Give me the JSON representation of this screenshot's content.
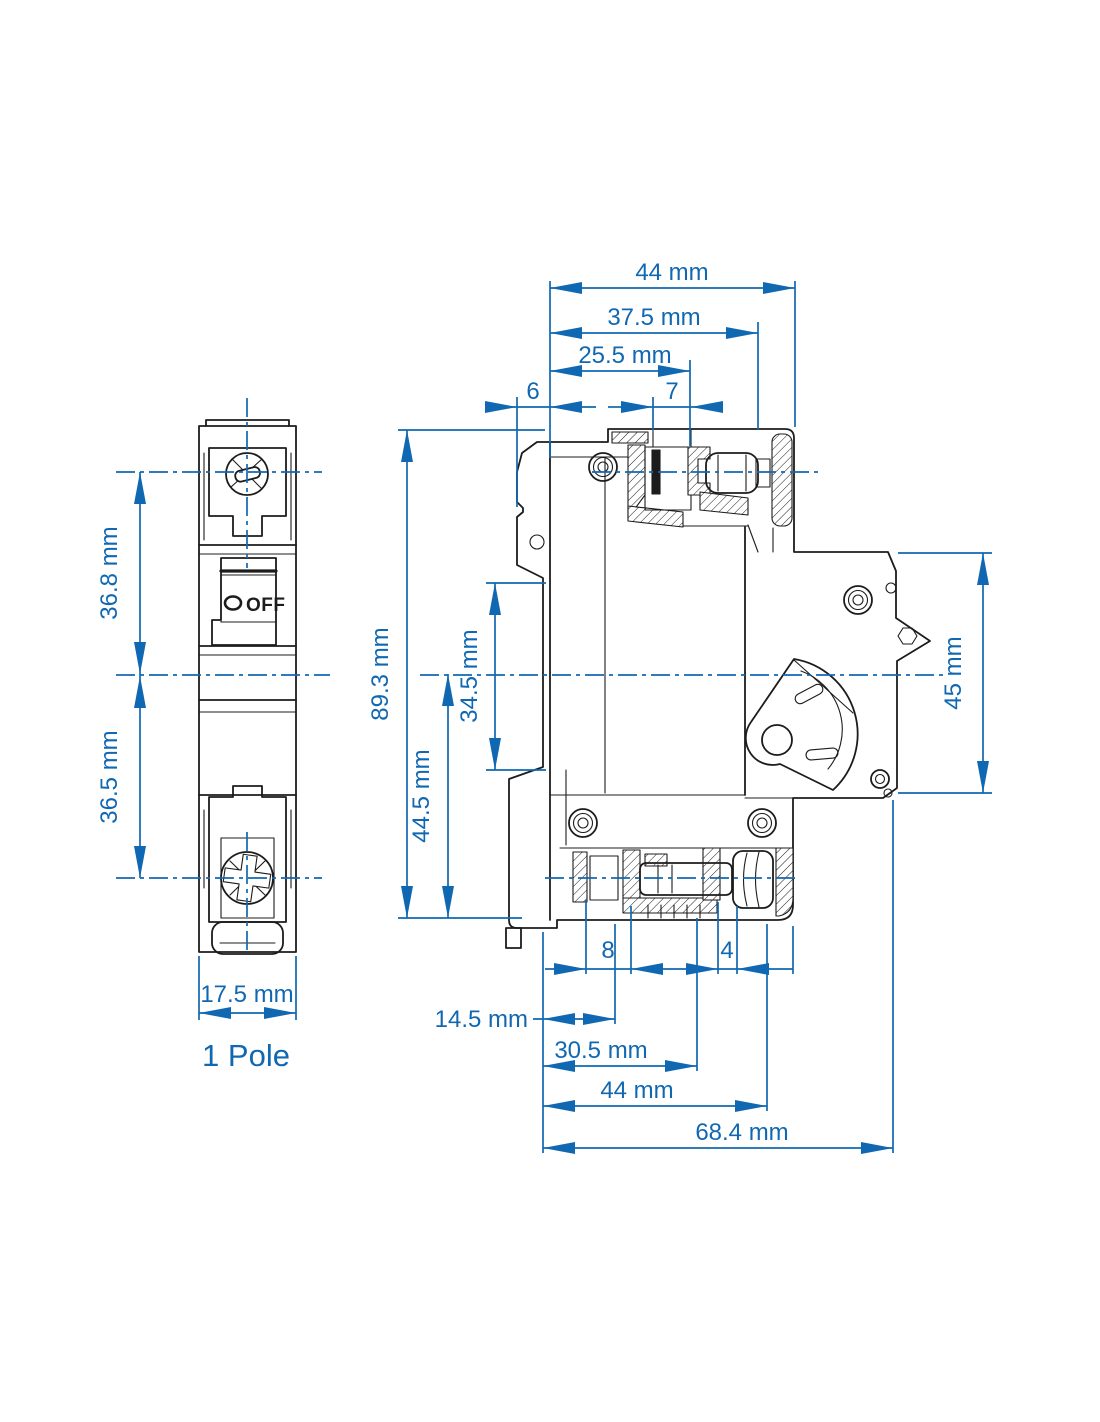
{
  "colors": {
    "accent": "#1168b2",
    "ink": "#1c1c1c"
  },
  "front_view": {
    "caption": "1 Pole",
    "off_label": "OFF",
    "dim_upper_height": "36.8 mm",
    "dim_lower_height": "36.5 mm",
    "dim_width": "17.5 mm"
  },
  "side_view": {
    "dim_top_total": "44 mm",
    "dim_top_mid": "37.5 mm",
    "dim_top_inner": "25.5 mm",
    "dim_front_step": "6",
    "dim_hole_width": "7",
    "dim_height_total": "89.3 mm",
    "dim_din_channel": "34.5 mm",
    "dim_lower_half": "44.5 mm",
    "dim_back_height": "45 mm",
    "dim_bottom_8": "8",
    "dim_bottom_4": "4",
    "dim_bottom_14_5": "14.5 mm",
    "dim_bottom_30_5": "30.5 mm",
    "dim_bottom_44": "44 mm",
    "dim_bottom_68_4": "68.4 mm"
  }
}
